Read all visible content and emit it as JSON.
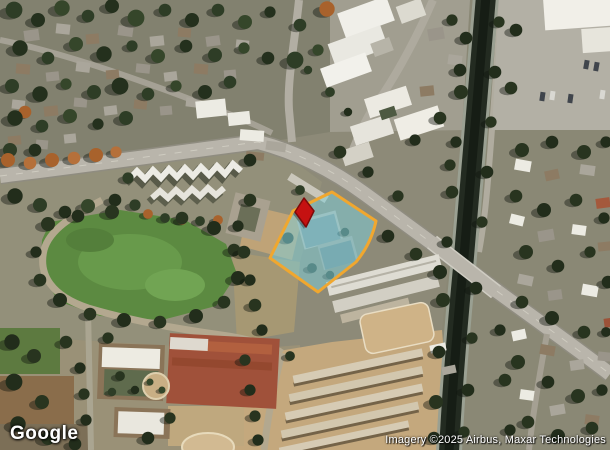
{
  "map": {
    "provider": "Google",
    "imagery_type": "satellite",
    "attribution": "Imagery ©2025 Airbus, Maxar Technologies",
    "parcel_highlight": {
      "fill_color": "#7FCFDA",
      "border_color": "#F0A72F"
    },
    "marker": {
      "color": "#C51111"
    }
  }
}
